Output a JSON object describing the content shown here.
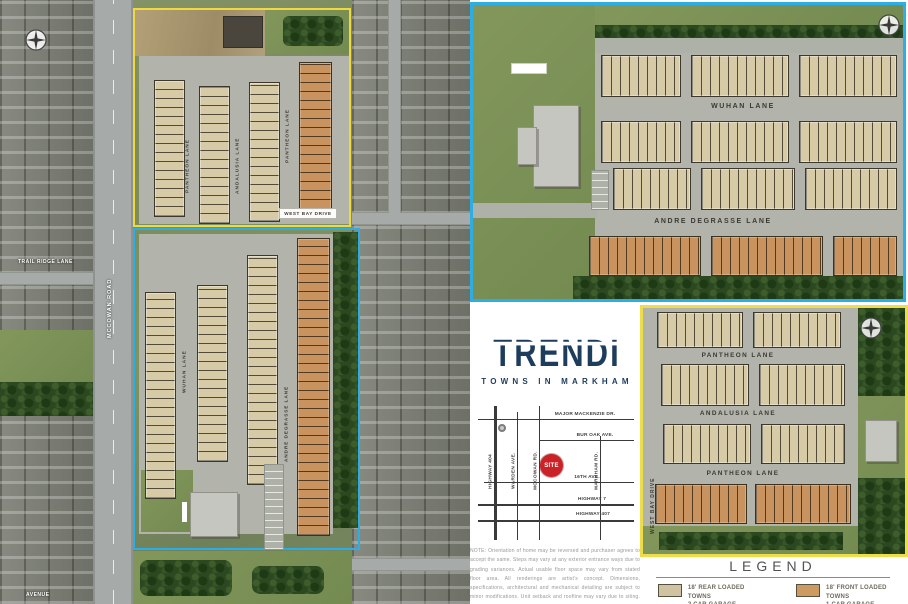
{
  "brand": {
    "logo": "TRENDI",
    "tagline": "TOWNS IN MARKHAM"
  },
  "colors": {
    "navy": "#1d3d5c",
    "cyan_outline": "#2aaee3",
    "yellow_outline": "#f0d93c",
    "rear_loaded_town": "#d0c3a2",
    "front_loaded_town": "#cd9a62",
    "site_marker_red": "#cb2228"
  },
  "aerial_panel": {
    "mccowan_road_label": "MCCOWAN ROAD",
    "trail_ridge_lane_label": "TRAIL RIDGE LANE",
    "avenue_label": "AVENUE",
    "north_site": {
      "pantheon_left": "PANTHEON LANE",
      "andalusia": "ANDALUSIA LANE",
      "pantheon_right": "PANTHEON LANE",
      "west_bay_drive": "WEST BAY DRIVE"
    },
    "south_site": {
      "wuhan_lane": "WUHAN LANE",
      "andre_degrasse_lane": "ANDRE DEGRASSE LANE"
    }
  },
  "north_block_plan": {
    "wuhan_lane": "WUHAN LANE",
    "andre_degrasse_lane": "ANDRE DEGRASSE LANE"
  },
  "south_block_plan": {
    "pantheon_lane_top": "PANTHEON LANE",
    "andalusia_lane": "ANDALUSIA LANE",
    "pantheon_lane_bottom": "PANTHEON LANE",
    "west_bay_drive": "WEST BAY DRIVE"
  },
  "location_map": {
    "horizontal_roads": [
      "MAJOR MACKENZIE DR.",
      "BUR OAK AVE.",
      "16TH AVE.",
      "HIGHWAY 7",
      "HIGHWAY 407"
    ],
    "vertical_roads": [
      "HIGHWAY 404",
      "WARDEN AVE.",
      "MCCOWAN RD.",
      "MARKHAM RD."
    ],
    "site_label": "SITE"
  },
  "disclaimer": "NOTE: Orientation of home may be reversed and purchaser agrees to accept the same. Steps may vary at any exterior entrance ways due to grading variances. Actual usable floor space may vary from stated floor area. All renderings are artist's concept. Dimensions, specifications, architectural and mechanical detailing are subject to minor modifications. Unit setback and roofline may vary due to siting. E. & O.E.",
  "legend": {
    "title": "LEGEND",
    "items": [
      {
        "swatch_color": "#d0c3a2",
        "label_line1": "18' REAR LOADED TOWNS",
        "label_line2": "2 CAR GARAGE"
      },
      {
        "swatch_color": "#cd9a62",
        "label_line1": "18' FRONT LOADED TOWNS",
        "label_line2": "1 CAR GARAGE"
      }
    ]
  }
}
